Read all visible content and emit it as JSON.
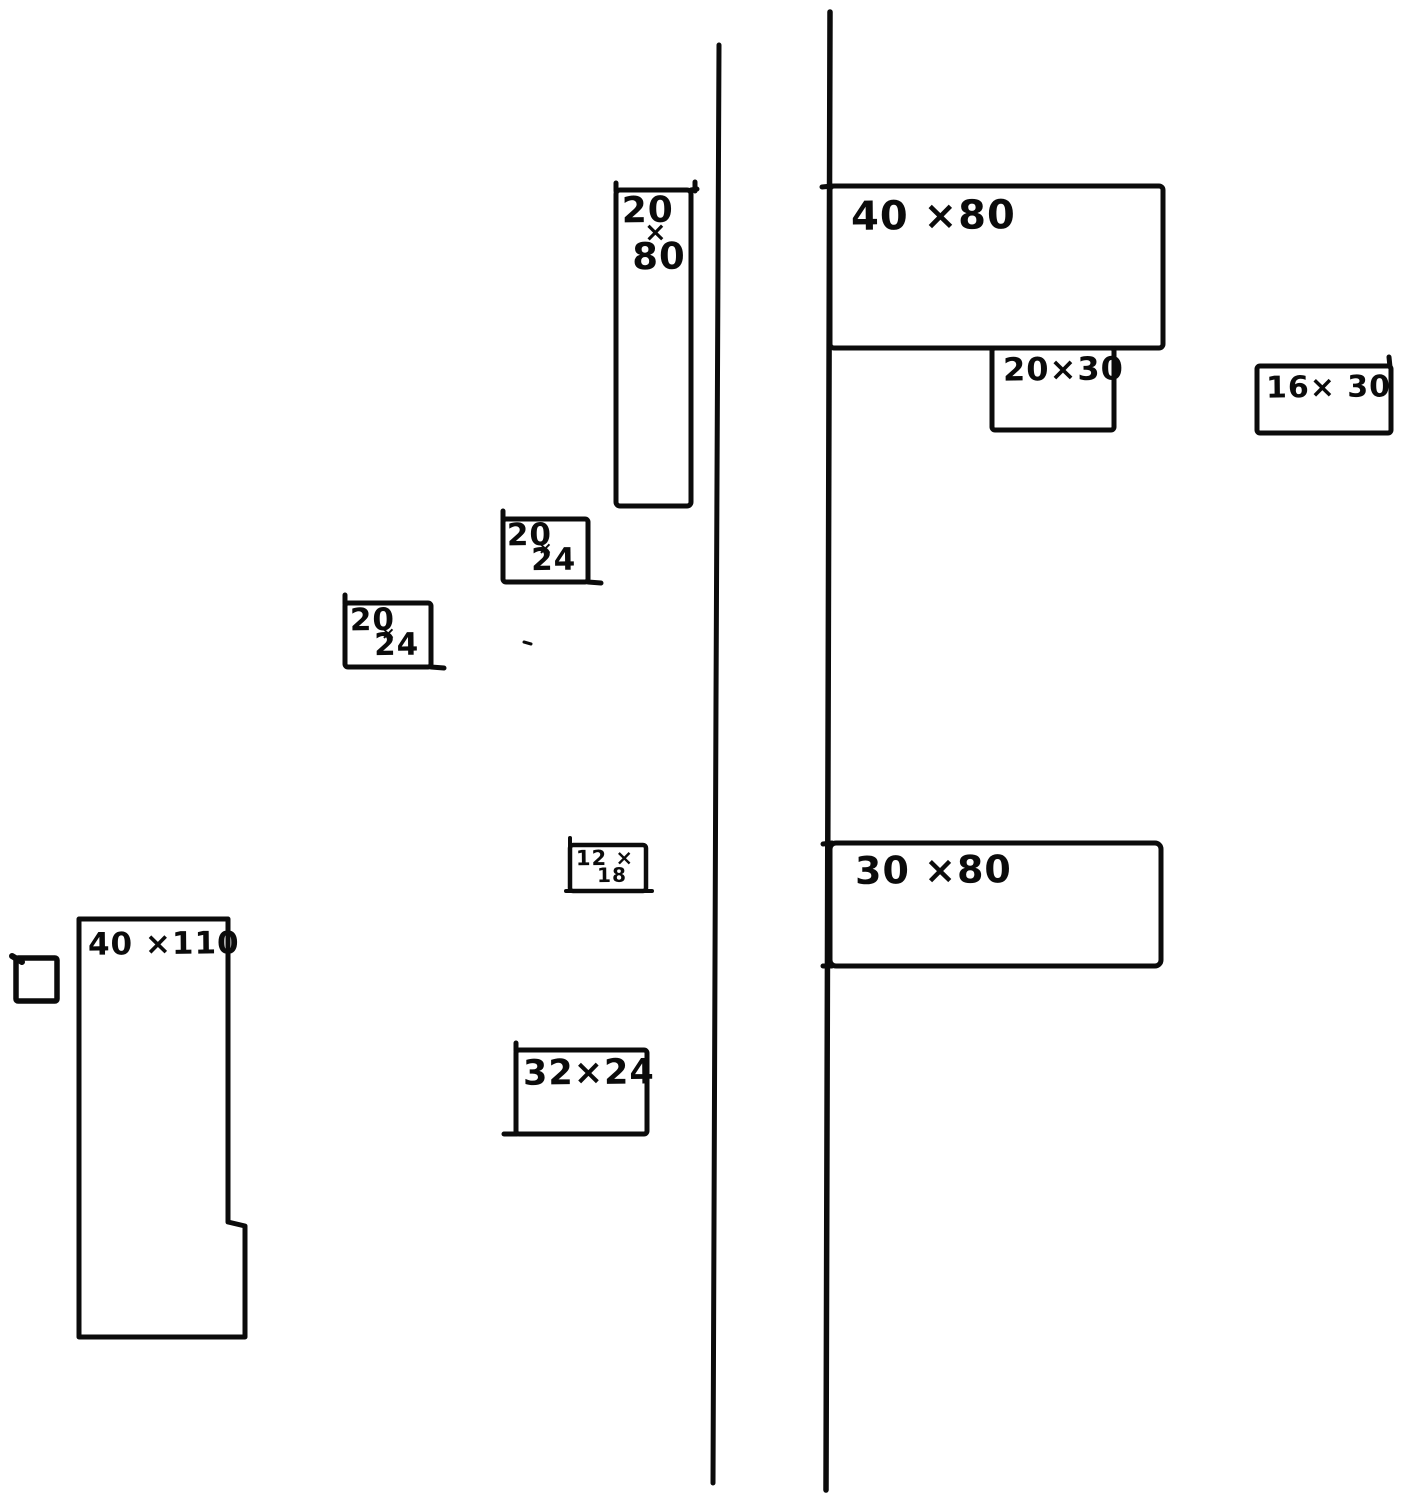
{
  "canvas": {
    "background": "#ffffff",
    "ink": "#0b0b0b",
    "kind": "hand-drawn plot plan with two street lines and dimension-labeled lots"
  },
  "lots": [
    {
      "name": "lot-20x80",
      "lines": [
        "20",
        "×",
        "80"
      ]
    },
    {
      "name": "lot-40x80",
      "label": "40 ×80"
    },
    {
      "name": "lot-20x30",
      "label": "20×30"
    },
    {
      "name": "lot-16x30",
      "label": "16× 30"
    },
    {
      "name": "lot-20x24-upper",
      "lines": [
        "20",
        "×",
        "24"
      ]
    },
    {
      "name": "lot-20x24-lower",
      "lines": [
        "20",
        "×",
        "24"
      ]
    },
    {
      "name": "lot-12x18",
      "lines": [
        "12 ×",
        "18"
      ]
    },
    {
      "name": "lot-30x80",
      "label": "30 ×80"
    },
    {
      "name": "lot-40x110",
      "label": "40 ×110"
    },
    {
      "name": "lot-32x24",
      "label": "32×24"
    },
    {
      "name": "small-square",
      "label": ""
    }
  ]
}
